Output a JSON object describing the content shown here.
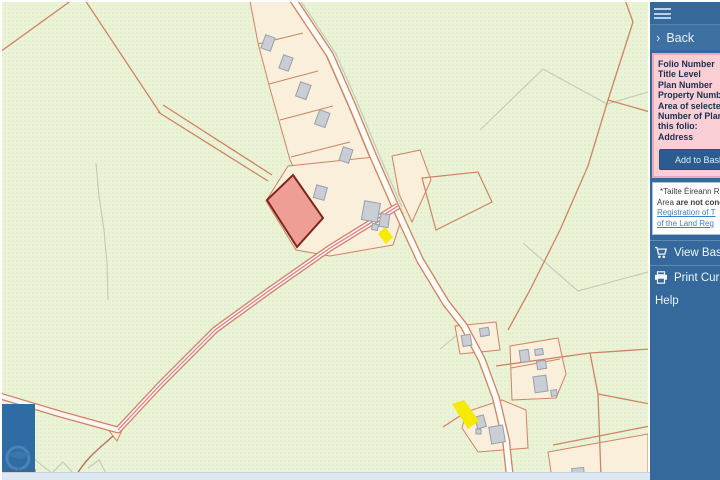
{
  "colors": {
    "sidebar_bg": "#35689b",
    "sidebar_back_bg": "#3e71a2",
    "panel_bg": "#f9ced5",
    "panel_border": "#f0a7b3",
    "panel_text": "#18304f",
    "button_bg": "#2b5c8f",
    "link": "#3f81c4",
    "map_bg": "#ebf3d7",
    "map_dot": "#ccdcae",
    "boundary": "#d08264",
    "road_fill": "#fefdf6",
    "plot_fill": "#f9efdb",
    "building_fill": "#c9cdd4",
    "building_stroke": "#989fae",
    "selected_parcel_fill": "#ef9e96",
    "selected_parcel_stroke": "#7c281c",
    "marker_yellow": "#f6ea00",
    "logo_blue": "#2e6ca3",
    "bottom_strip": "#dde8f1"
  },
  "sidebar": {
    "back_label": "Back",
    "panel": {
      "fields": [
        "Folio Number",
        "Title Level",
        "Plan Number",
        "Property Number",
        "Area of selected",
        "Number of Plans in",
        "this folio:",
        "Address"
      ],
      "add_button_label": "Add to Basket"
    },
    "disclaimer": {
      "line1": "*Tailte Éireann Re",
      "line2_normal": "Area ",
      "line2_bold": "are not conc",
      "link_line1": "Registration of T",
      "link_line2": "of the Land Reg"
    },
    "view_basket_label": "View Basket",
    "print_label": "Print Current",
    "help_label": "Help"
  },
  "map": {
    "attribution": "Tailte Éireann",
    "selected_parcel": "selected-folio-parcel",
    "marker_north": "plan-marker-north",
    "marker_south": "plan-marker-south"
  }
}
